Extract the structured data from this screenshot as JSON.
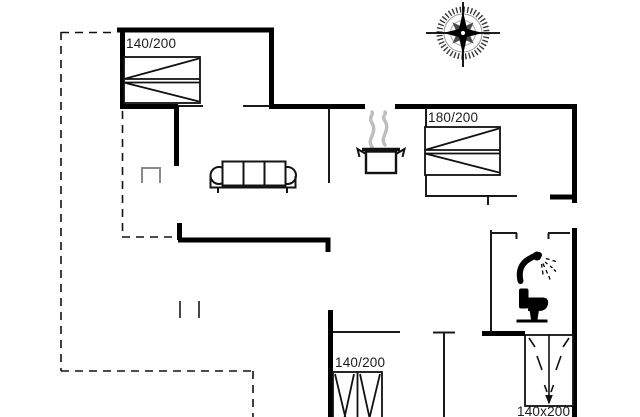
{
  "labels": {
    "bed_top_left": "140/200",
    "bed_right": "180/200",
    "bed_bottom_left": "140/200",
    "bed_bottom_right": "140x200"
  },
  "colors": {
    "wall": "#000000",
    "interior_wall": "#1a1a1a",
    "terrace_dash": "#111111",
    "furniture_gray": "#8a8a8a",
    "steam_gray": "#bdbdbd",
    "background": "#ffffff"
  },
  "icons": [
    "compass-rose-icon",
    "double-bed-icon-top-left",
    "double-bed-icon-right",
    "bed-icon-bottom-left",
    "bed-icon-bottom-right",
    "sofa-icon",
    "cooking-pot-icon",
    "steam-icon",
    "shower-icon",
    "toilet-icon",
    "side-table-icon"
  ]
}
